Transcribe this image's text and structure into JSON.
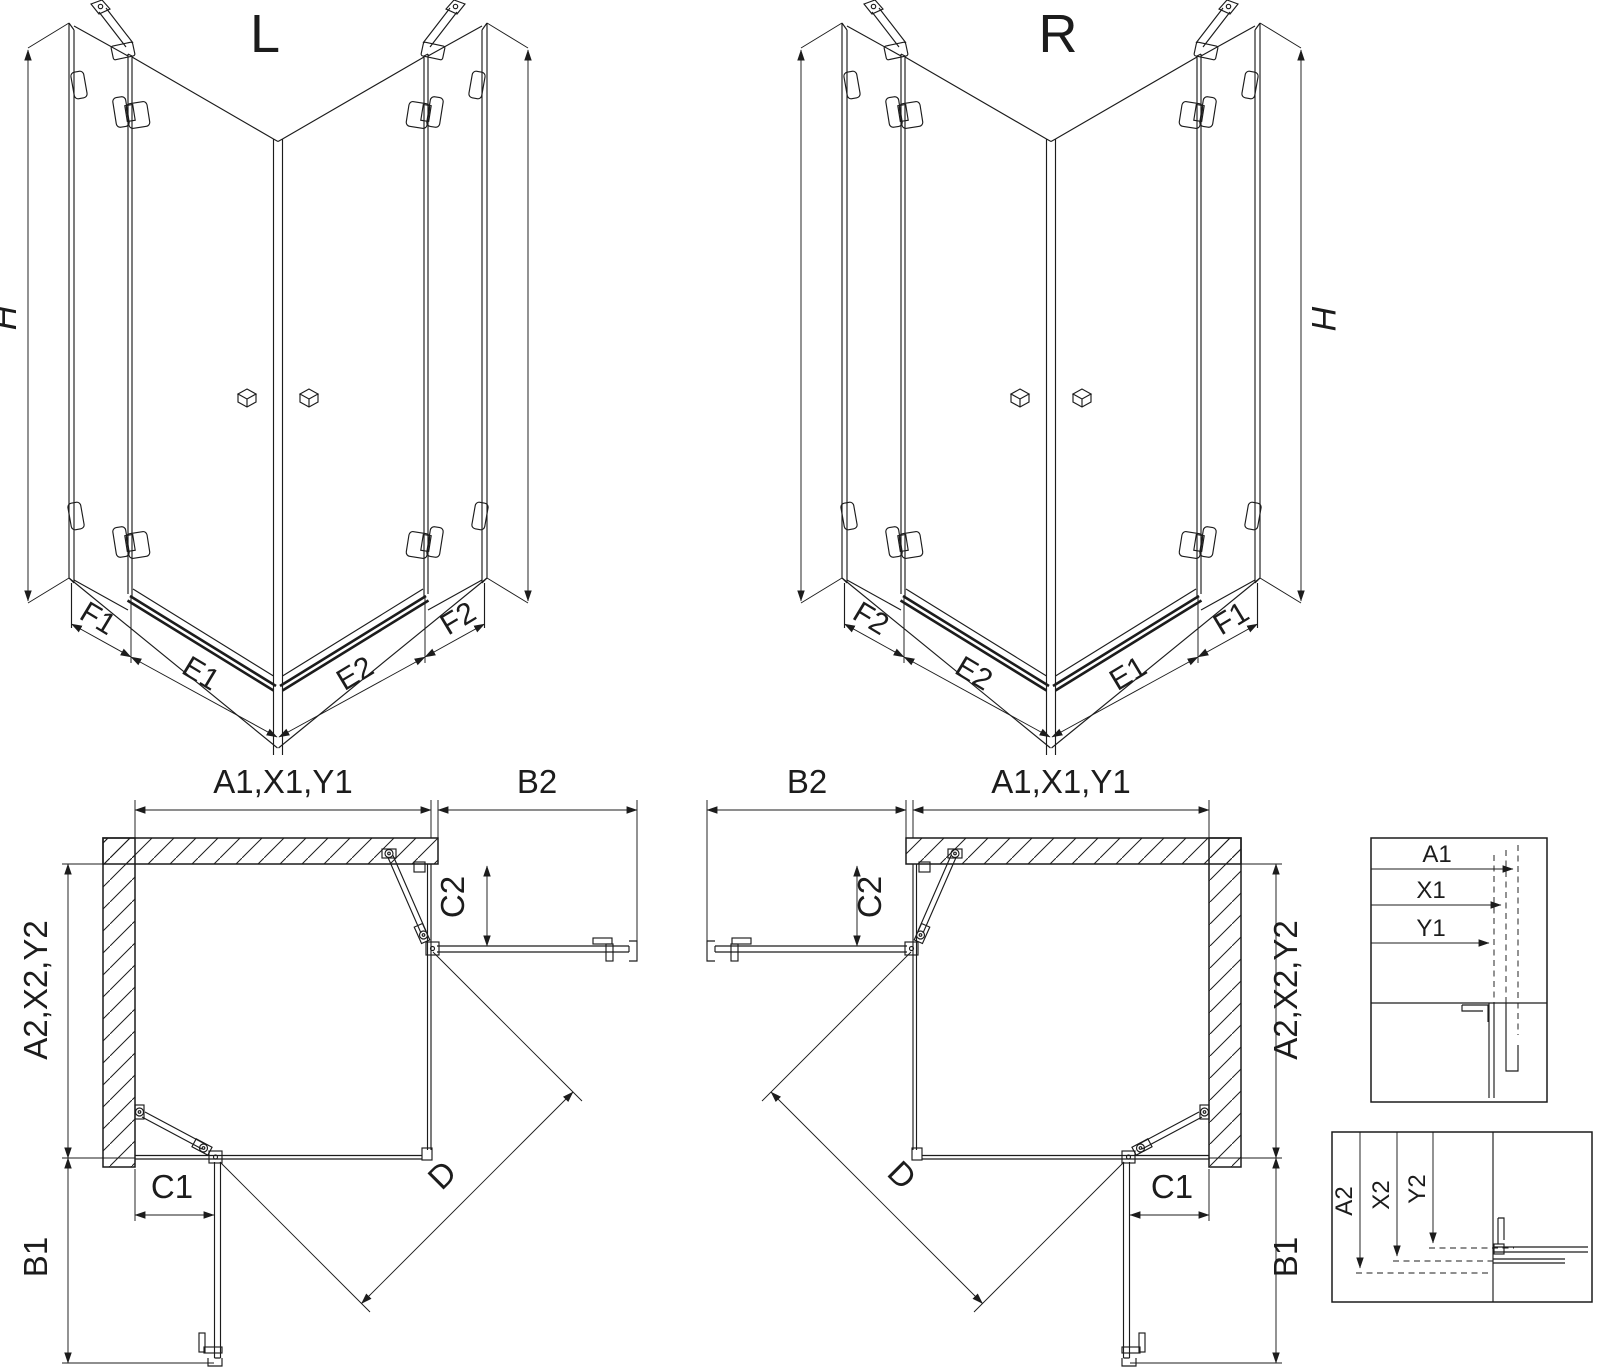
{
  "drawing": {
    "type": "shower-enclosure-technical-drawing",
    "colors": {
      "line": "#1c1c1c",
      "background": "#ffffff"
    }
  },
  "iso_left": {
    "title": "L",
    "height_label": "H",
    "segments": [
      "F1",
      "E1",
      "E2",
      "F2"
    ]
  },
  "iso_right": {
    "title": "R",
    "height_label": "H",
    "segments": [
      "F2",
      "E2",
      "E1",
      "F1"
    ]
  },
  "plan_left": {
    "width_top": "A1,X1,Y1",
    "width_door_open": "B2",
    "depth_left": "A2,X2,Y2",
    "depth_door_open": "B1",
    "fixed_panel_side": "C2",
    "fixed_panel_bottom": "C1",
    "diagonal": "D"
  },
  "plan_right": {
    "width_top": "A1,X1,Y1",
    "width_door_open": "B2",
    "depth_right": "A2,X2,Y2",
    "depth_door_open": "B1",
    "fixed_panel_side": "C2",
    "fixed_panel_bottom": "C1",
    "diagonal": "D"
  },
  "detail_horizontal": {
    "labels": [
      "A1",
      "X1",
      "Y1"
    ]
  },
  "detail_vertical": {
    "labels": [
      "A2",
      "X2",
      "Y2"
    ]
  }
}
